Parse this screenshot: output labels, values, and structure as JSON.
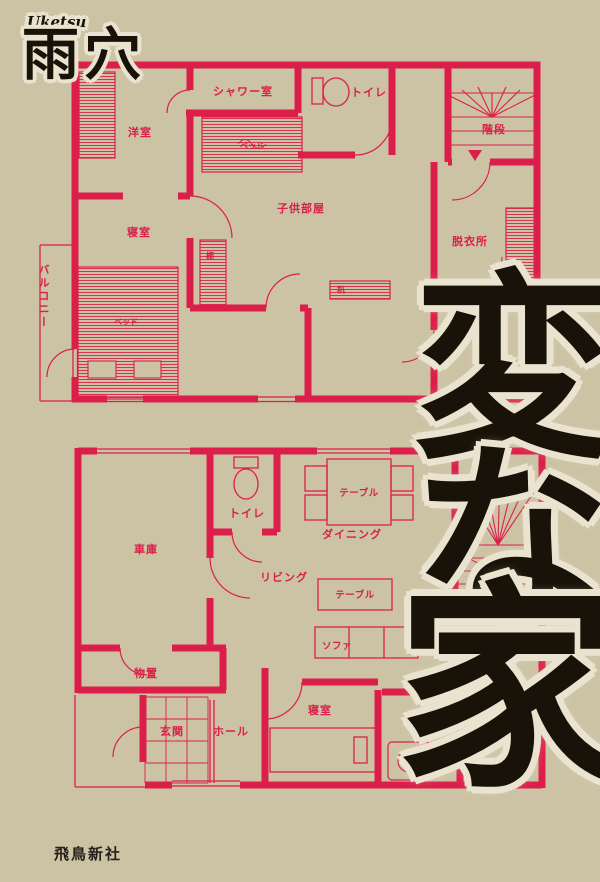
{
  "cover": {
    "author_romaji": "Uketsu",
    "author_name": "雨穴",
    "publisher": "飛鳥新社",
    "title": "変な家",
    "title_chars": [
      "変",
      "な",
      "家"
    ],
    "colors": {
      "background": "#CCC2A4",
      "plan_red": "#DC1F4A",
      "ink": "#181209",
      "halo": "#EAE3CF"
    }
  },
  "upper_floor": {
    "labels": {
      "western_room": "洋室",
      "shower_room": "シャワー室",
      "toilet": "トイレ",
      "stairs": "階段",
      "kids_room": "子供部屋",
      "bedroom": "寝室",
      "dressing_room": "脱衣所",
      "balcony": "バルコニー",
      "bed_small": "ベッド",
      "bed_large": "ベッド",
      "shelf": "棚",
      "desk": "机"
    }
  },
  "lower_floor": {
    "labels": {
      "garage": "車庫",
      "toilet": "トイレ",
      "dining": "ダイニング",
      "dining_table": "テーブル",
      "living": "リビング",
      "living_table": "テーブル",
      "sofa": "ソファ",
      "storage": "物置",
      "entrance": "玄関",
      "hall": "ホール",
      "bedroom": "寝室",
      "stairs": "階段"
    }
  }
}
